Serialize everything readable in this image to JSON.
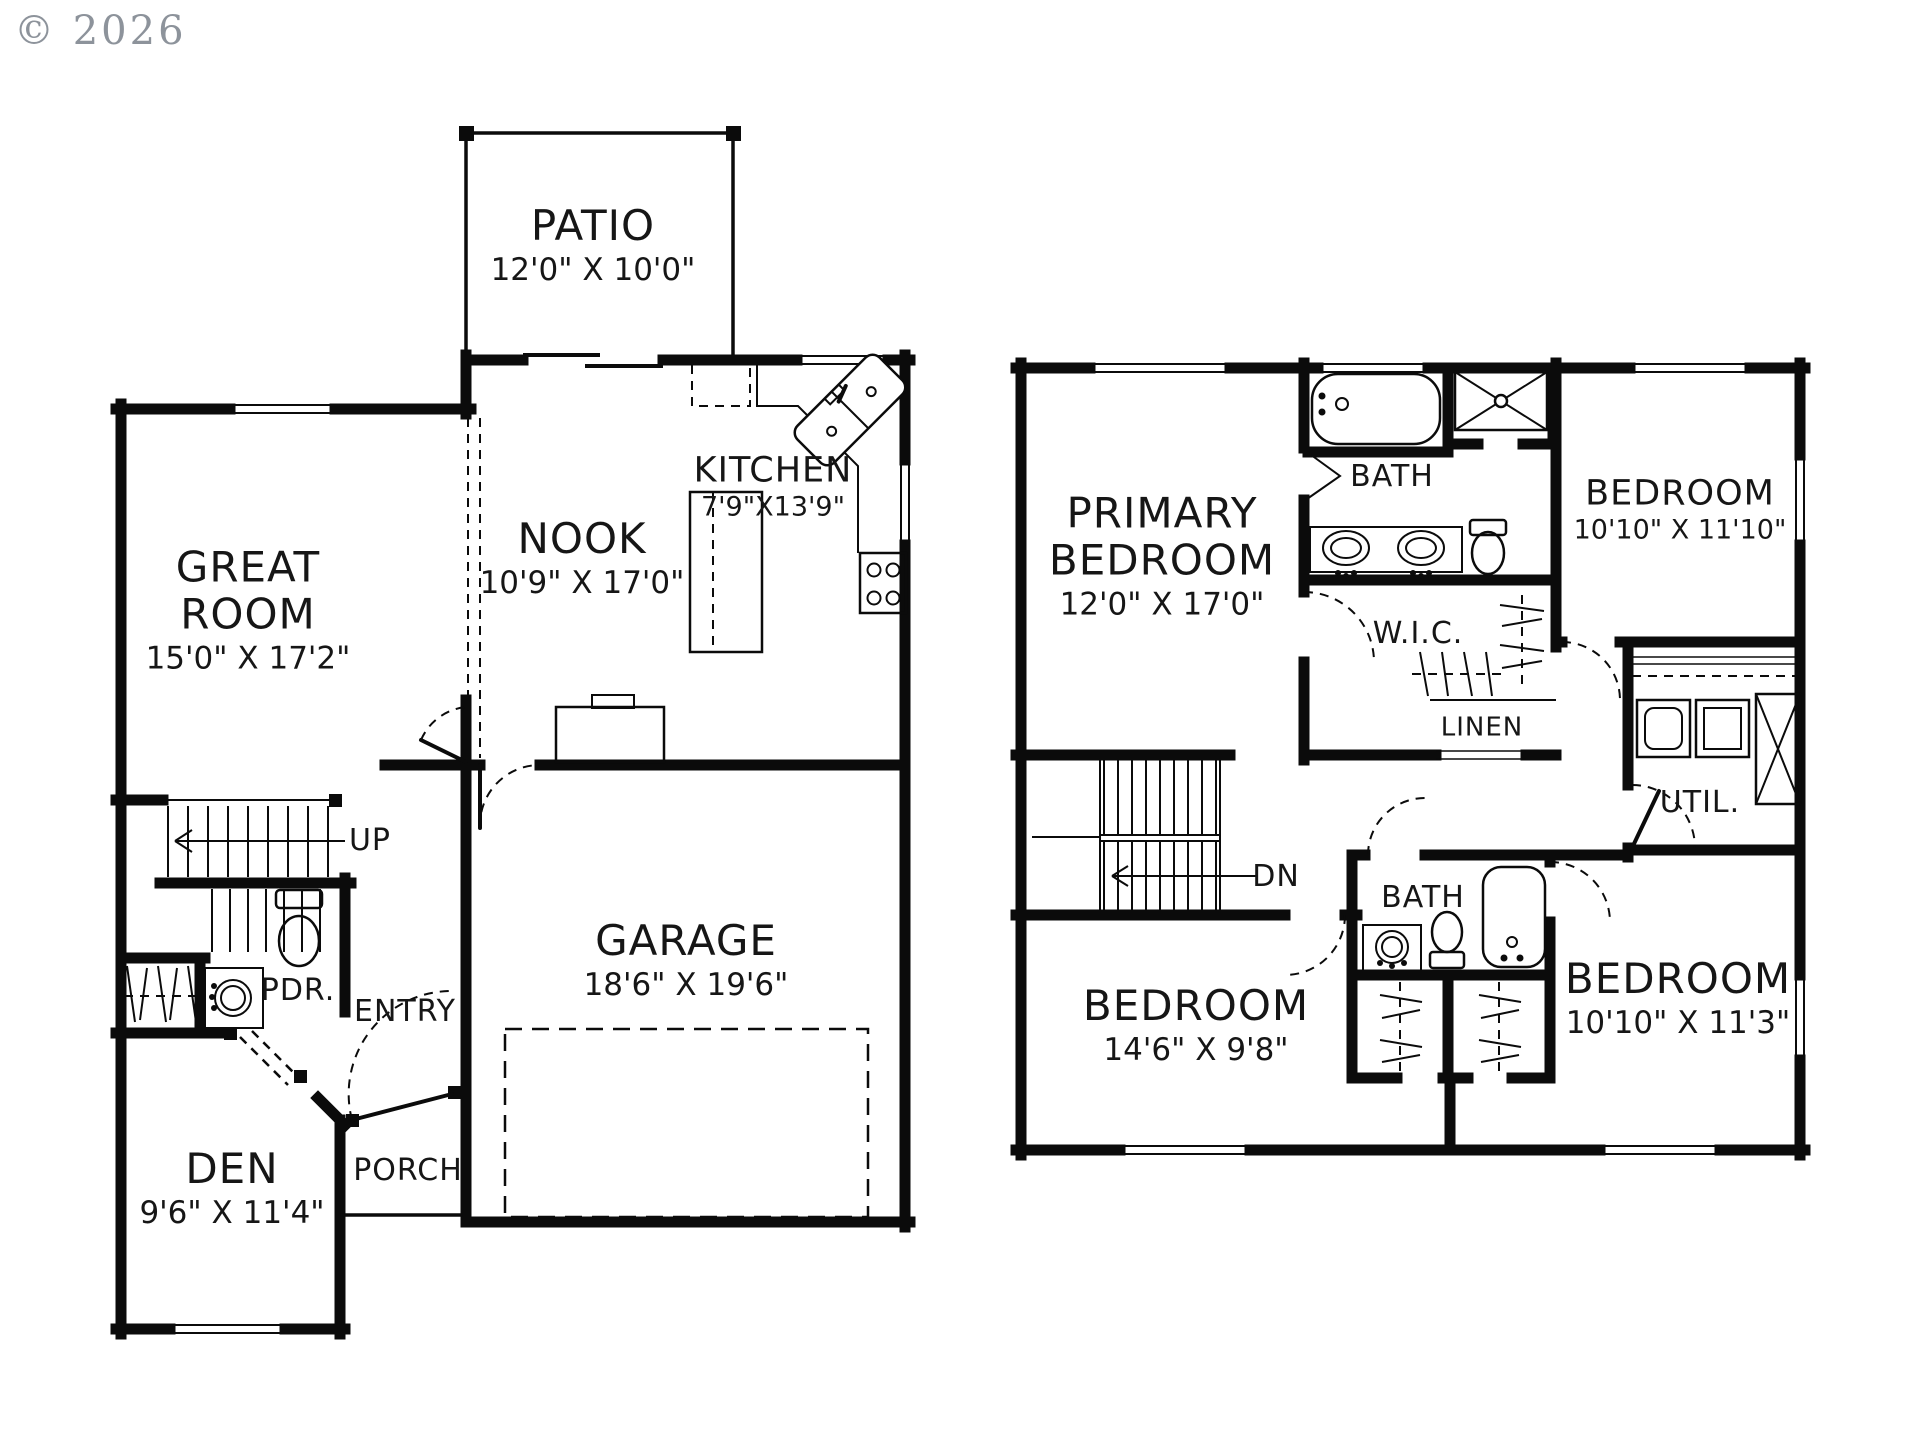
{
  "copyright": "© 2026",
  "colors": {
    "line": "#0b0b0b",
    "background": "#ffffff",
    "copyright_gray": "#8d939b"
  },
  "floor1": {
    "patio": {
      "name": "PATIO",
      "dims": "12'0\" X 10'0\""
    },
    "nook": {
      "name": "NOOK",
      "dims": "10'9\" X 17'0\""
    },
    "kitchen": {
      "name": "KITCHEN",
      "dims": "7'9\"X13'9\""
    },
    "great_room": {
      "name_line1": "GREAT",
      "name_line2": "ROOM",
      "dims": "15'0\" X 17'2\""
    },
    "garage": {
      "name": "GARAGE",
      "dims": "18'6\" X 19'6\""
    },
    "den": {
      "name": "DEN",
      "dims": "9'6\" X 11'4\""
    },
    "entry": {
      "name": "ENTRY"
    },
    "powder": {
      "name": "PDR."
    },
    "porch": {
      "name": "PORCH"
    },
    "stair_direction": "UP"
  },
  "floor2": {
    "primary_bedroom": {
      "name_line1": "PRIMARY",
      "name_line2": "BEDROOM",
      "dims": "12'0\" X 17'0\""
    },
    "bath_upper": {
      "name": "BATH"
    },
    "bedroom_ne": {
      "name": "BEDROOM",
      "dims": "10'10\" X 11'10\""
    },
    "wic": {
      "name": "W.I.C."
    },
    "linen": {
      "name": "LINEN"
    },
    "util": {
      "name": "UTIL."
    },
    "bath_lower": {
      "name": "BATH"
    },
    "bedroom_sw": {
      "name": "BEDROOM",
      "dims": "14'6\" X 9'8\""
    },
    "bedroom_se": {
      "name": "BEDROOM",
      "dims": "10'10\" X 11'3\""
    },
    "stair_direction": "DN"
  }
}
